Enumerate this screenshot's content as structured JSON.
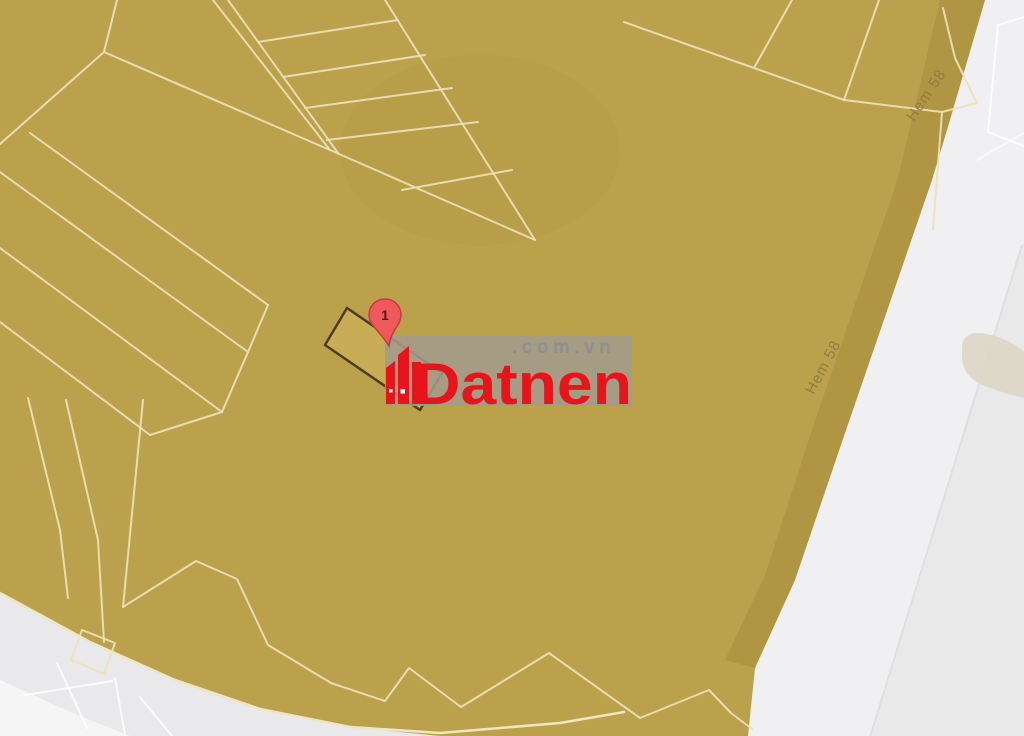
{
  "marker": {
    "label": "1"
  },
  "street_labels": {
    "right": "Hem 58",
    "top": "Hem 58"
  },
  "watermark": {
    "brand": "Datnen",
    "suffix": ".com.vn"
  },
  "colors": {
    "golden": "#bba14c",
    "golden-light": "#c9ad56",
    "golden-dark": "#9d8531",
    "parcel-line": "#ece1ba",
    "boundary-line": "#f0e6c0",
    "parcel-highlight-border": "#4a3d22",
    "street-gray": "#f0f0f2",
    "street-gray-dark": "#e9e9ec",
    "street-gray-darker": "#eae9e9",
    "street-gray-light": "#f5f5f6",
    "divider": "#e0dfe0",
    "white-line": "#ffffff",
    "tan-blob": "#ddd6c6",
    "marker-fill": "#f0595c",
    "marker-stroke": "#c43b41",
    "marker-text": "#5a1517",
    "logo-red": "#e8141c",
    "logo-gray": "#8f8f8f",
    "patch": "#a29b8b",
    "street-label": "#8b7a42"
  }
}
